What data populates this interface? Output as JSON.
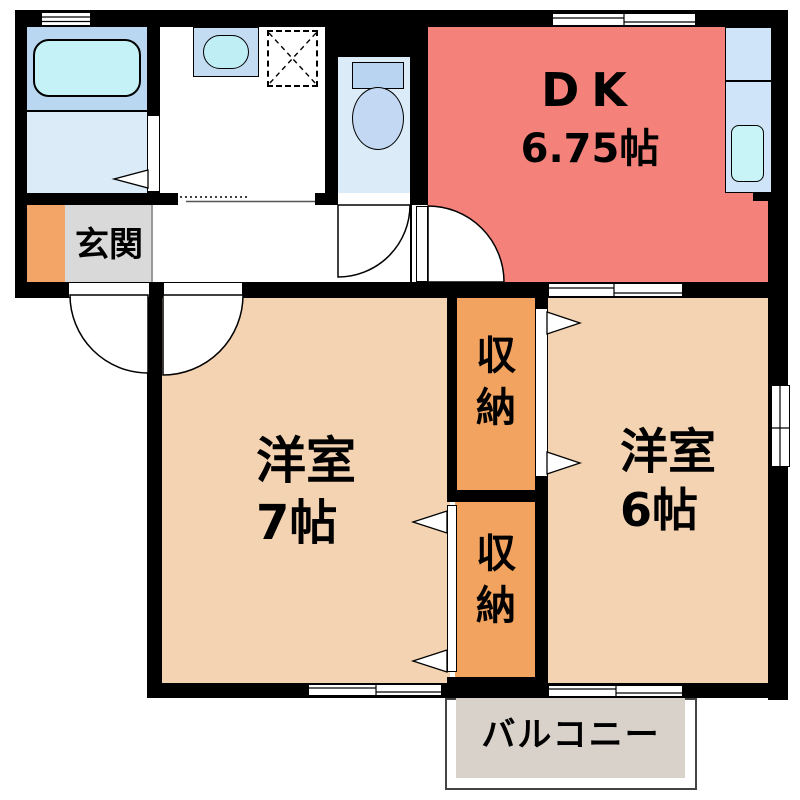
{
  "plan": {
    "type": "floor-plan",
    "rooms": {
      "dk": {
        "label": "DK",
        "size": "6.75帖"
      },
      "western_left": {
        "label": "洋室",
        "size": "7帖"
      },
      "western_right": {
        "label": "洋室",
        "size": "6帖"
      },
      "closet_upper": {
        "char1": "収",
        "char2": "納"
      },
      "closet_lower": {
        "char1": "収",
        "char2": "納"
      },
      "entrance": {
        "label": "玄関"
      },
      "balcony": {
        "label": "バルコニー"
      }
    },
    "fixtures": [
      "bathtub",
      "washbasin",
      "washing-machine-space",
      "toilet",
      "kitchen-counter",
      "kitchen-sink"
    ],
    "colors": {
      "wall": "#000000",
      "dk_floor": "#f4827a",
      "western_room_floor": "#f3d3b1",
      "closet_floor": "#f1a35f",
      "entrance_accent": "#f2a566",
      "entrance_floor": "#d9d9d9",
      "balcony_floor": "#d8d2cb",
      "bath_zone": "#b9d7f0",
      "bath_floor": "#dcebf8",
      "water_fixture": "#c5f2f7",
      "kitchen_counter": "#cfe4f8"
    }
  }
}
